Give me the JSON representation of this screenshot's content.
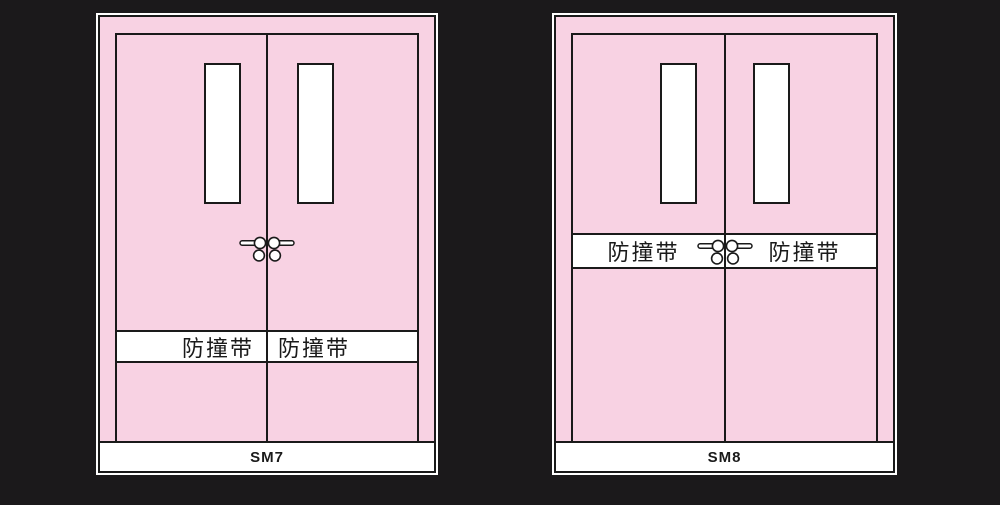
{
  "colors": {
    "background": "#1b191b",
    "door_pink": "#f8d2e3",
    "line": "#1a1a1a",
    "glass_white": "#ffffff",
    "panel_white": "#ffffff"
  },
  "diagrams": [
    {
      "label": "SM7",
      "strip": {
        "left_text": "防撞带",
        "right_text": "防撞带",
        "position": "lower-third"
      },
      "leaves": 2,
      "windows": 2,
      "handles_icon": "lever-handle-pair"
    },
    {
      "label": "SM8",
      "strip": {
        "left_text": "防撞带",
        "right_text": "防撞带",
        "position": "middle-at-handles"
      },
      "leaves": 2,
      "windows": 2,
      "handles_icon": "lever-handle-pair"
    }
  ]
}
